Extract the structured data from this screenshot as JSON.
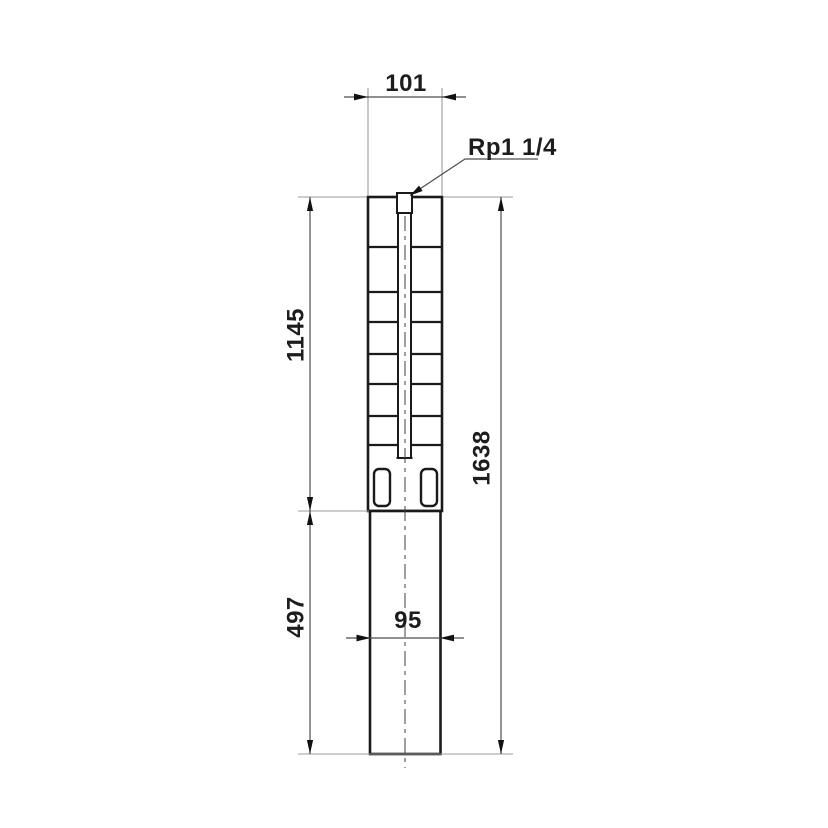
{
  "drawing": {
    "port_label": "Rp1 1/4",
    "dimensions": {
      "top_width": "101",
      "upper_height": "1145",
      "total_height": "1638",
      "lower_height": "497",
      "motor_width": "95"
    },
    "colors": {
      "background": "#ffffff",
      "outline": "#1a1a1a",
      "dimension_line": "#4d4d4d",
      "extension_line": "#9b9b9b",
      "text": "#1d1d1d"
    }
  }
}
